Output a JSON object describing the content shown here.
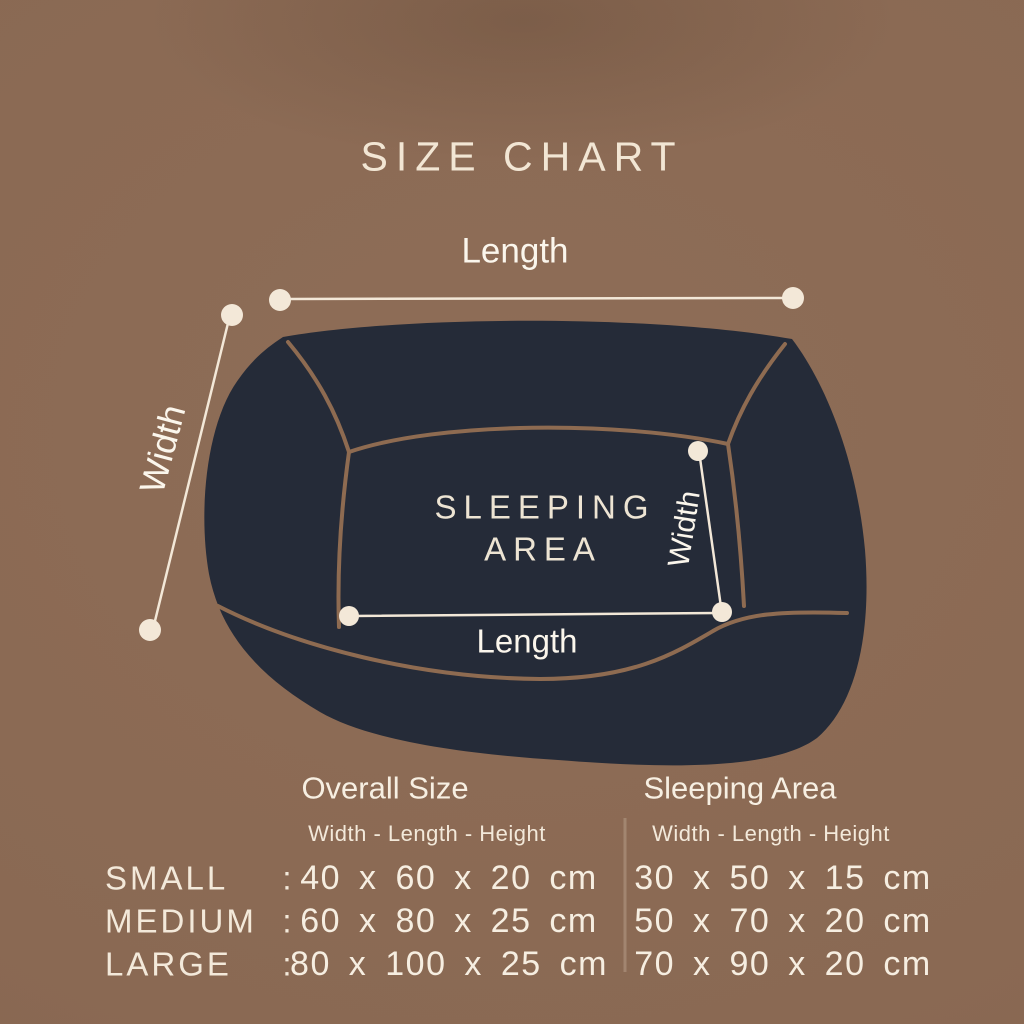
{
  "title": "SIZE CHART",
  "diagram": {
    "overall_length_label": "Length",
    "overall_width_label": "Width",
    "sleeping_area_line1": "SLEEPING",
    "sleeping_area_line2": "AREA",
    "inner_width_label": "Width",
    "inner_length_label": "Length"
  },
  "table": {
    "columns": [
      {
        "header": "Overall Size",
        "subheader": "Width - Length - Height"
      },
      {
        "header": "Sleeping Area",
        "subheader": "Width - Length - Height"
      }
    ],
    "separator": ":",
    "rows": [
      {
        "name": "SMALL",
        "overall": "40 x 60 x 20 cm",
        "sleeping": "30 x 50 x 15 cm"
      },
      {
        "name": "MEDIUM",
        "overall": "60 x 80 x 25 cm",
        "sleeping": "50 x 70 x 20 cm"
      },
      {
        "name": "LARGE",
        "overall": "80 x 100 x 25 cm",
        "sleeping": "70 x 90 x 20 cm"
      }
    ]
  },
  "colors": {
    "background": "#8b6a54",
    "bed_fill": "#252b38",
    "seam_brown": "#8e6b51",
    "measure_cream": "#f3e8d8",
    "text_cream": "#f7efe2"
  }
}
